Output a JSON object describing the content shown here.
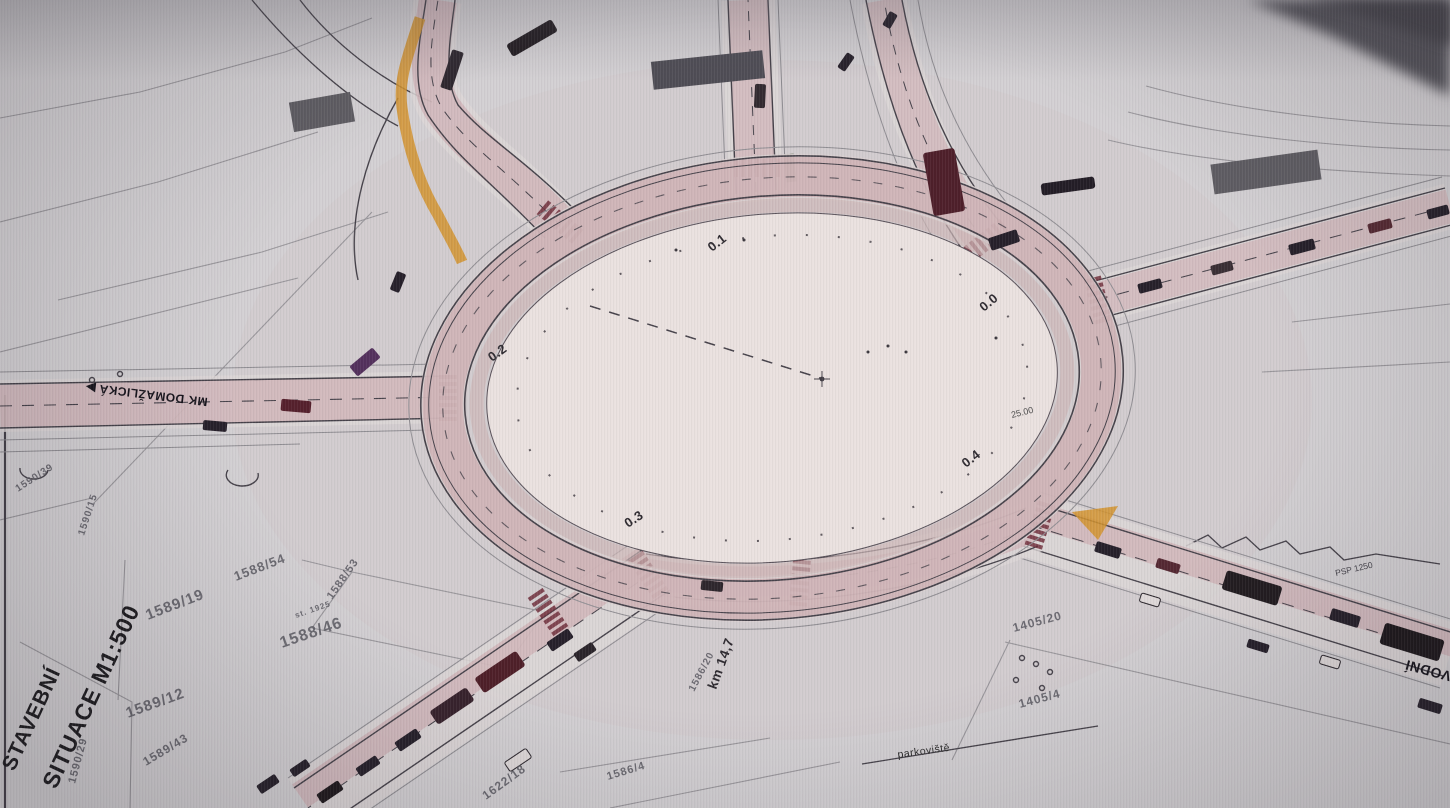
{
  "document": {
    "title_block": {
      "line1": "STAVEBNÍ",
      "line2": "SITUACE M1:500"
    },
    "street_labels": {
      "west_arm": "MK DOMAŽLICKÁ ▶",
      "southeast_edge": "VODNÍ",
      "parking_area": "parkoviště",
      "fence_note": "PSP 1250"
    },
    "parcel_numbers": {
      "p1590_39": "1590/39",
      "p1590_15": "1590/15",
      "p1590_29": "1590/29",
      "p1589_19": "1589/19",
      "p1588_54": "1588/54",
      "p1588_53": "1588/53",
      "p_st_1925": "st. 1925",
      "p1588_46": "1588/46",
      "p1589_12": "1589/12",
      "p1589_43": "1589/43",
      "p1622_18": "1622/18",
      "p1586_4": "1586/4",
      "p1586_20": "1586/20",
      "p1405_20": "1405/20",
      "p1405_4": "1405/4"
    },
    "station_marks": {
      "s0": "0.0",
      "s1": "0.1",
      "s2": "0.2",
      "s3": "0.3",
      "s4": "0.4",
      "radius": "25.00",
      "chainage": "km 14,7"
    },
    "colors": {
      "paper": "#d3d0d3",
      "island_paper": "#eae1df",
      "road_pink": "#c9a0a6",
      "hatch_red": "#6f2f3c",
      "island_orange": "#d2932f",
      "vehicle_dark": "#26202a",
      "bus_red": "#4e1f28",
      "bus_purple": "#53305c",
      "ink": "#46424a",
      "cadastral_gray": "#8f8d92",
      "photo_corner": "#55535a"
    }
  }
}
